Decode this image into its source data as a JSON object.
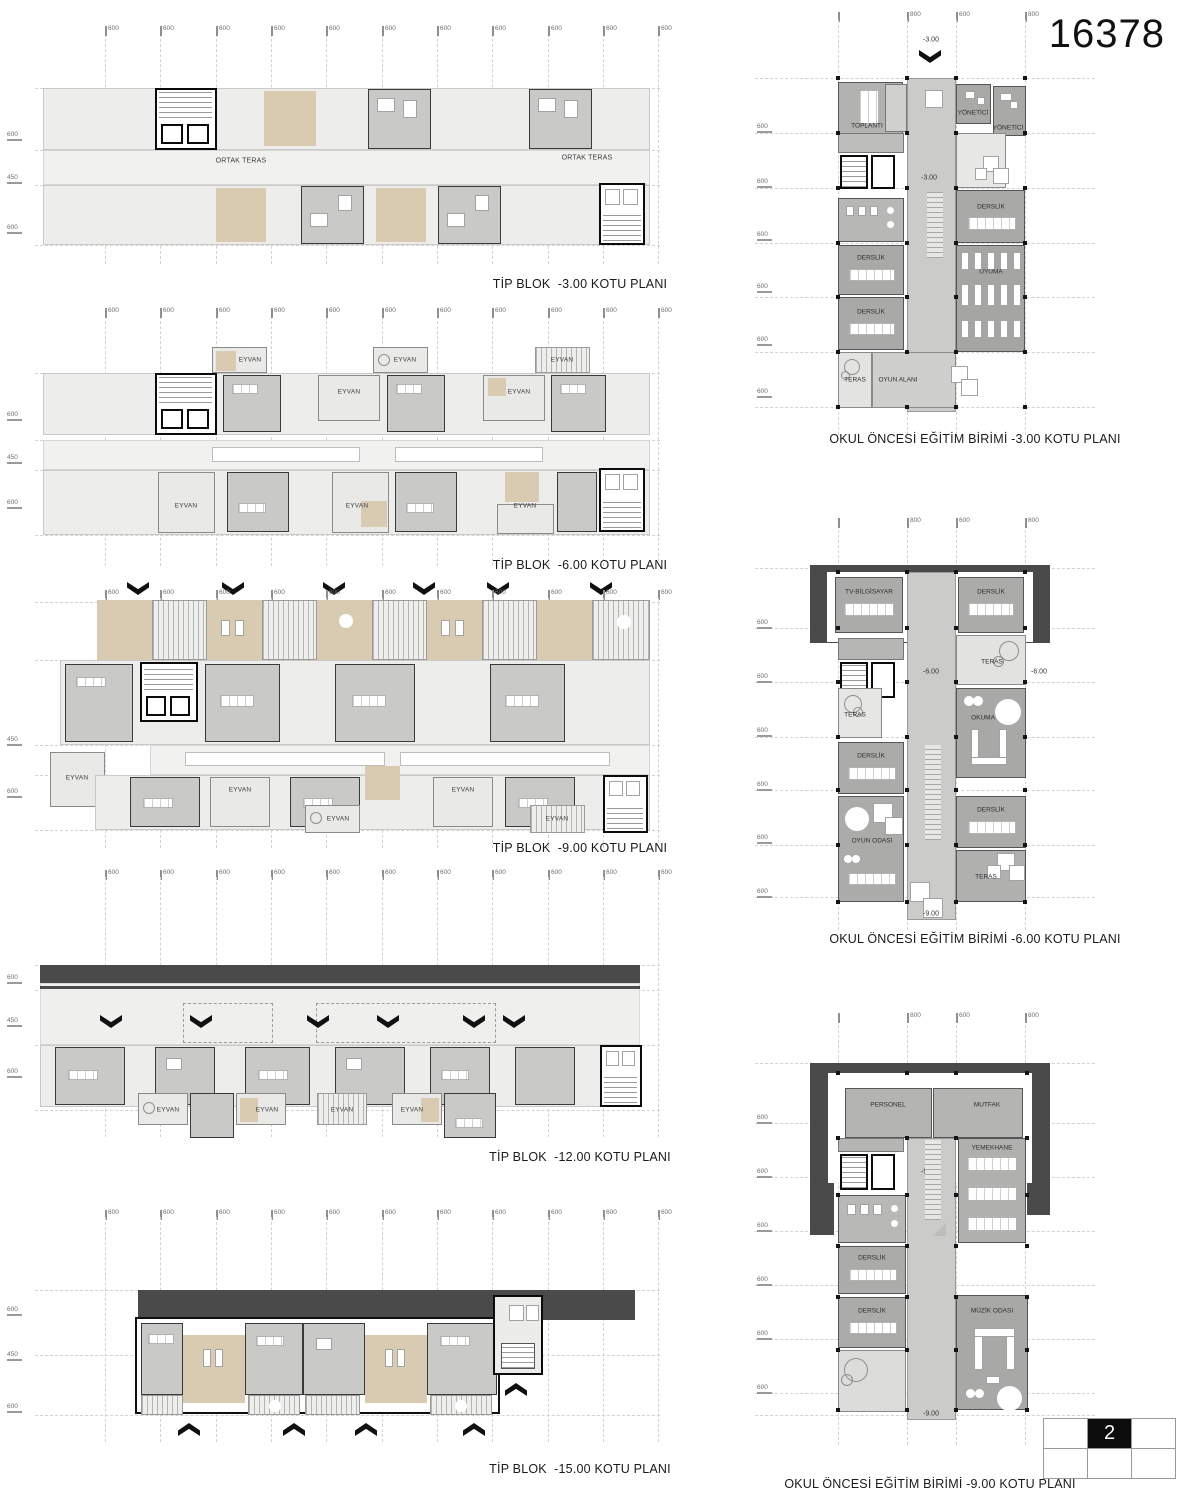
{
  "sheet": {
    "number": "16378",
    "page_number": "2"
  },
  "dims": {
    "d600": "600",
    "d450": "450",
    "d800": "800"
  },
  "levels": {
    "l3": "-3.00",
    "l6": "-6.00",
    "l9": "-9.00"
  },
  "labels": {
    "ortak_teras": "ORTAK TERAS",
    "eyvan": "EYVAN",
    "toplanti": "TOPLANTI",
    "yonetici": "YÖNETİCİ",
    "derslik": "DERSLİK",
    "uyuma": "UYUMA",
    "teras": "TERAS",
    "oyun_alani": "OYUN ALANI",
    "tv_bilgisayar": "TV-BİLGİSAYAR",
    "okuma": "OKUMA",
    "oyun_odasi": "OYUN ODASI",
    "personel": "PERSONEL",
    "mutfak": "MUTFAK",
    "yemekhane": "YEMEKHANE",
    "muzik_odasi": "MÜZİK ODASI"
  },
  "titles": {
    "tip_blok_3": "TİP BLOK  -3.00 KOTU PLANI",
    "tip_blok_6": "TİP BLOK  -6.00 KOTU PLANI",
    "tip_blok_9": "TİP BLOK  -9.00 KOTU PLANI",
    "tip_blok_12": "TİP BLOK  -12.00 KOTU PLANI",
    "tip_blok_15": "TİP BLOK  -15.00 KOTU PLANI",
    "okul_3": "OKUL ÖNCESİ EĞİTİM BİRİMİ -3.00 KOTU PLANI",
    "okul_6": "OKUL ÖNCESİ EĞİTİM BİRİMİ -6.00 KOTU PLANI",
    "okul_9": "OKUL ÖNCESİ EĞİTİM BİRİMİ -9.00 KOTU PLANI"
  },
  "colors": {
    "tan": "#d9cbb2",
    "dark_band": "#4a4a4a",
    "room_mid": "#ababaa",
    "corridor": "#cbcbca",
    "plan_light": "#ededec"
  }
}
